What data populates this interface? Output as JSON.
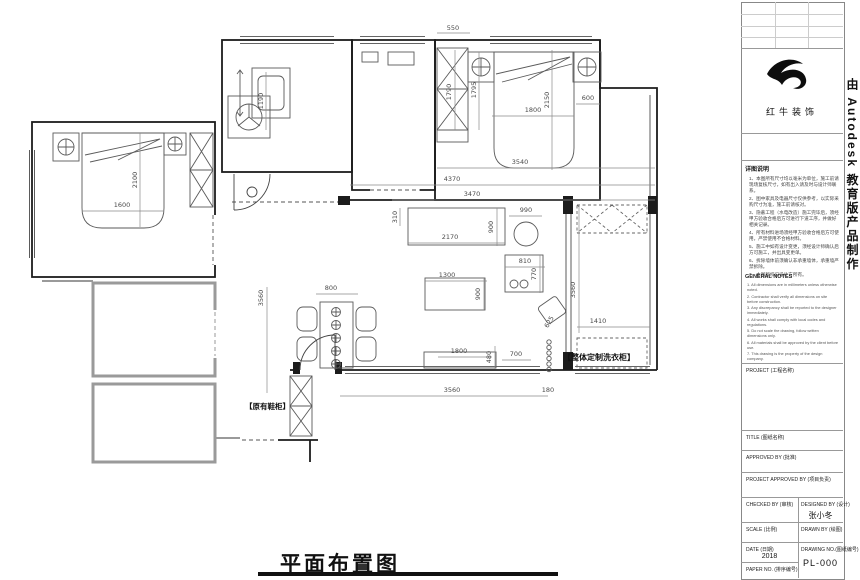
{
  "watermark": "由 Autodesk 教育版产品制作",
  "plan": {
    "title": "平面布置图",
    "labels": {
      "laundry_cabinet": "【整体定制洗衣柜】",
      "shoe_cabinet": "【原有鞋柜】"
    },
    "dims": {
      "top_550": "550",
      "bath_vanity_1190": "1190",
      "wardrobe2_1790": "1790",
      "bed2_side_1795": "1795",
      "bed2_len_2150": "2150",
      "bed2_wid_1800": "1800",
      "niche_600": "600",
      "bedroom2_3540": "3540",
      "span_4370": "4370",
      "span_3470": "3470",
      "counter_310": "310",
      "counter_2170": "2170",
      "counter_900": "900",
      "table_990": "990",
      "island_810": "810",
      "island_770": "770",
      "coffee_1300": "1300",
      "coffee_900": "900",
      "chair_625": "625",
      "dining_800": "800",
      "tv_1800": "1800",
      "tv_480": "480",
      "tv_700": "700",
      "balcony_1410": "1410",
      "balcony_3560": "3560",
      "bottom_3560": "3560",
      "bottom_180": "180",
      "hall_3560": "3560",
      "bed1_2100": "2100",
      "bed1_1600": "1600"
    }
  },
  "titleblock": {
    "logo_text": "红牛装饰",
    "notes_title": "详图说明",
    "notes": [
      "1、本图所有尺寸均以毫米为单位，施工前请现场复核尺寸，如有出入请及时与设计师联系。",
      "2、图中家具及电器尺寸仅供参考，以实际采购尺寸为准，施工前请核对。",
      "3、隐蔽工程（水电改造）施工完毕后，须经甲方验收合格后方可进行下道工序，并做好相关记录。",
      "4、所有材料进场须经甲方验收合格后方可使用，严禁使用不合格材料。",
      "5、施工中如有设计变更，须经设计师确认后方可施工，并出具变更单。",
      "6、拆除墙体前须确认非承重墙体，承重墙严禁拆除。",
      "7、本图版权归设计方所有。"
    ],
    "general_notes_title": "GENERAL NOTES",
    "general_notes": [
      "1. All dimensions are in millimeters unless otherwise noted.",
      "2. Contractor shall verify all dimensions on site before construction.",
      "3. Any discrepancy shall be reported to the designer immediately.",
      "4. All works shall comply with local codes and regulations.",
      "5. Do not scale the drawing, follow written dimensions only.",
      "6. All materials shall be approved by the client before use.",
      "7. This drawing is the property of the design company."
    ],
    "fields": {
      "project": "PROJECT (工程名称)",
      "title": "TITLE (图纸名称)",
      "approved": "APPROVED BY (批准)",
      "project_approved": "PROJECT APPROVED BY (项目负责)",
      "checked": "CHECKED BY (审核)",
      "designed": "DESIGNED BY (设计)",
      "designer_name": "张小冬",
      "scale": "SCALE (比例)",
      "drawn": "DRAWN BY (绘图)",
      "date": "DATE (日期)",
      "date_value": "2018",
      "drawing_no": "DRAWING NO.(图纸编号)",
      "drawing_no_value": "PL-000",
      "paper_no": "PAPER NO. (排序编号)"
    }
  }
}
